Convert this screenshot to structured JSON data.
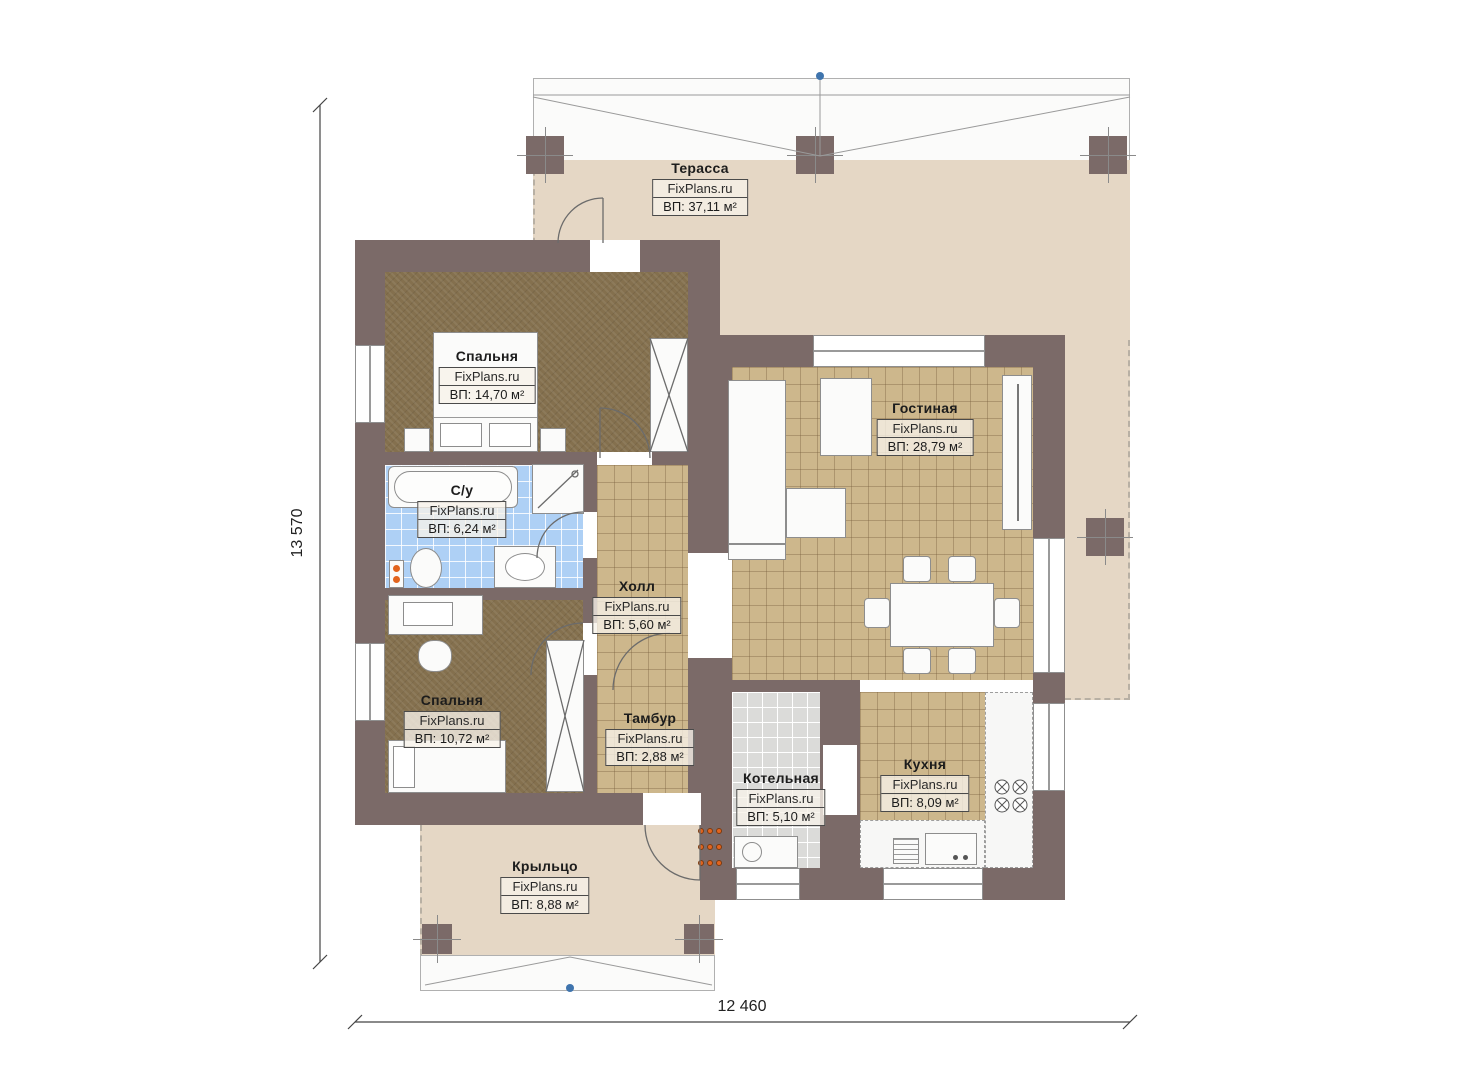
{
  "plan": {
    "brand": "FixPlans.ru",
    "rooms": [
      {
        "name": "Терасса",
        "area": "ВП: 37,11 м²"
      },
      {
        "name": "Спальня",
        "area": "ВП: 14,70 м²"
      },
      {
        "name": "С/у",
        "area": "ВП: 6,24 м²"
      },
      {
        "name": "Холл",
        "area": "ВП: 5,60 м²"
      },
      {
        "name": "Гостиная",
        "area": "ВП: 28,79 м²"
      },
      {
        "name": "Спальня",
        "area": "ВП: 10,72 м²"
      },
      {
        "name": "Тамбур",
        "area": "ВП: 2,88 м²"
      },
      {
        "name": "Котельная",
        "area": "ВП: 5,10 м²"
      },
      {
        "name": "Кухня",
        "area": "ВП: 8,09 м²"
      },
      {
        "name": "Крыльцо",
        "area": "ВП: 8,88 м²"
      }
    ],
    "dimensions": {
      "height_label": "13 570",
      "width_label": "12 460"
    },
    "colors": {
      "wall": "#7b6a68",
      "bedroom_floor": "#84704e",
      "tile_floor": "#cdb78c",
      "bath_floor": "#aed0f5",
      "boiler_floor": "#dbdbd9",
      "terrace_floor": "#e5d7c5",
      "furniture": "#fbfbfa",
      "marker_blue": "#3f74ad",
      "radiator_orange": "#e2641e"
    }
  }
}
